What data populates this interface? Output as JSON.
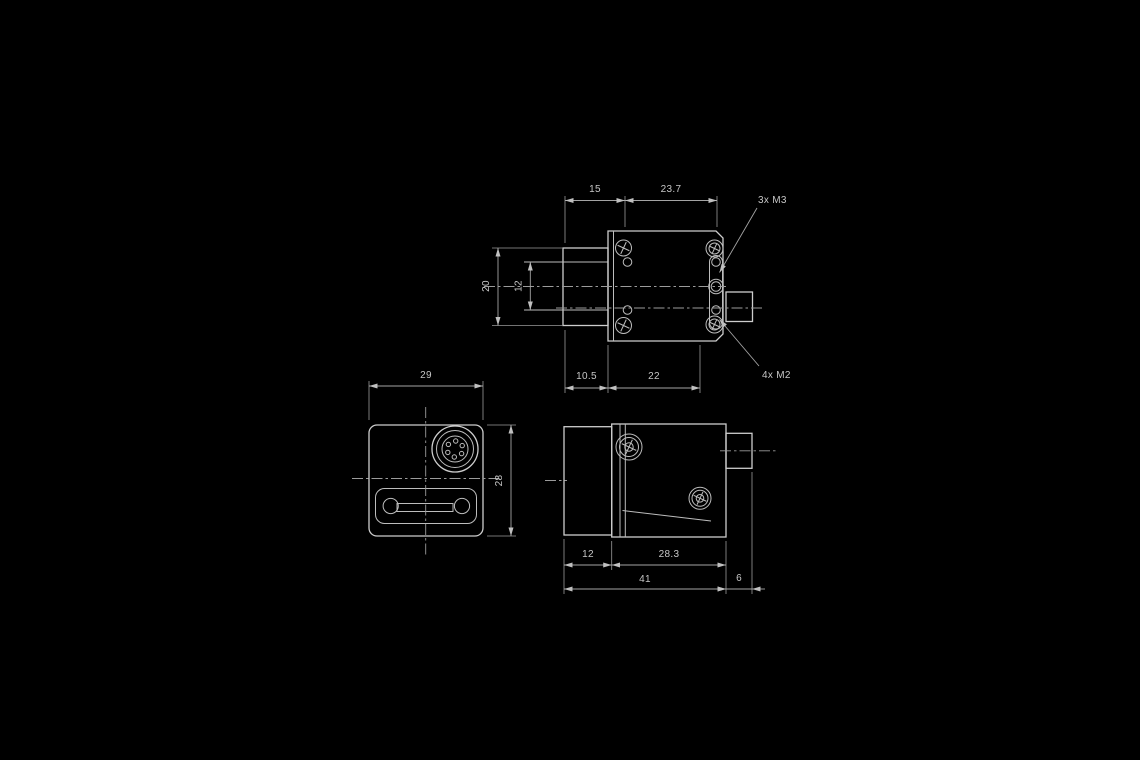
{
  "meta": {
    "drawing_type": "technical dimension drawing, industrial camera, three orthographic views",
    "background_color": "#000000",
    "line_color": "#cdcdcd",
    "text_color": "#c6c6c6"
  },
  "top_view": {
    "dim_front_section": "15",
    "dim_mount_span": "23.7",
    "dim_lens_section": "10.5",
    "dim_rear_section": "22",
    "dim_outer_spacing": "20",
    "dim_inner_spacing": "12",
    "thread_label_m3": "3x M3",
    "thread_label_m2": "4x M2"
  },
  "front_view": {
    "dim_width": "29",
    "dim_height": "28"
  },
  "side_view": {
    "dim_lens_length": "12",
    "dim_body_length": "28.3",
    "dim_total_length": "41",
    "dim_connector_length": "6"
  }
}
